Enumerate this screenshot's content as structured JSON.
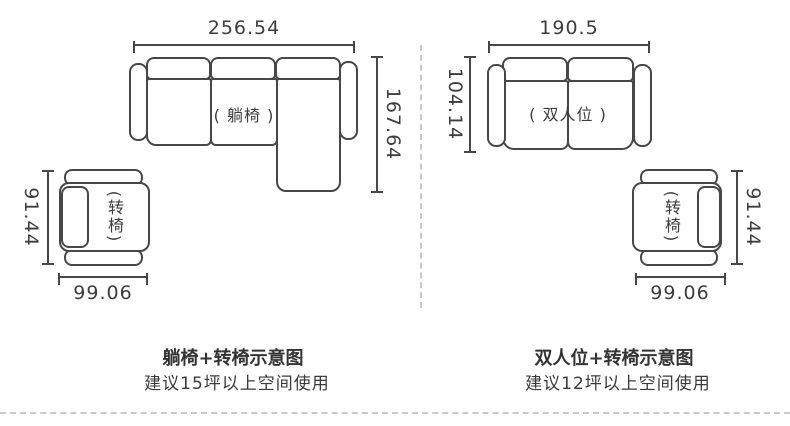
{
  "colors": {
    "line": "#474747",
    "text": "#3d3d3d",
    "divider": "#c8c8c8",
    "background": "#ffffff"
  },
  "left_diagram": {
    "sofa": {
      "width_value": "256.54",
      "height_value": "167.64",
      "seat_label": "( 躺椅 )"
    },
    "chair": {
      "height_value": "91.44",
      "width_value": "99.06",
      "label": "(转椅)"
    },
    "caption_title": "躺椅+转椅示意图",
    "caption_subtitle": "建议15坪以上空间使用"
  },
  "right_diagram": {
    "sofa": {
      "width_value": "190.5",
      "height_value": "104.14",
      "seat_label": "( 双人位 )"
    },
    "chair": {
      "height_value": "91.44",
      "width_value": "99.06",
      "label": "(转椅)"
    },
    "caption_title": "双人位+转椅示意图",
    "caption_subtitle": "建议12坪以上空间使用"
  }
}
